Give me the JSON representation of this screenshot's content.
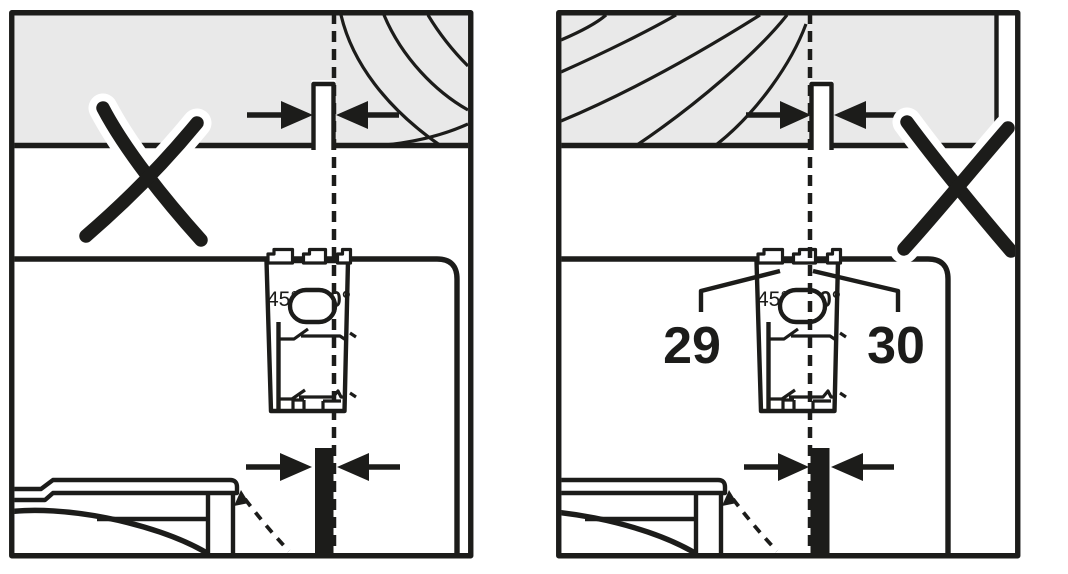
{
  "labels": {
    "angle_45": "45°",
    "angle_0": "0°",
    "callout_29": "29",
    "callout_30": "30"
  },
  "colors": {
    "line": "#1c1c1a",
    "workpiece_fill": "#e9e9e9",
    "blade": "#1c1c1a",
    "background": "#ffffff"
  },
  "icons": {
    "x_mark": "hand-drawn-cross-with-white-halo",
    "width_arrow": "filled-triangle-arrow",
    "cut_line": "vertical-dashed-line"
  },
  "panels": {
    "left": {
      "x_mark": "present",
      "kerf_arrows": 2,
      "blade_arrows": 2
    },
    "right": {
      "x_mark": "present",
      "kerf_arrows": 2,
      "blade_arrows": 2
    }
  }
}
